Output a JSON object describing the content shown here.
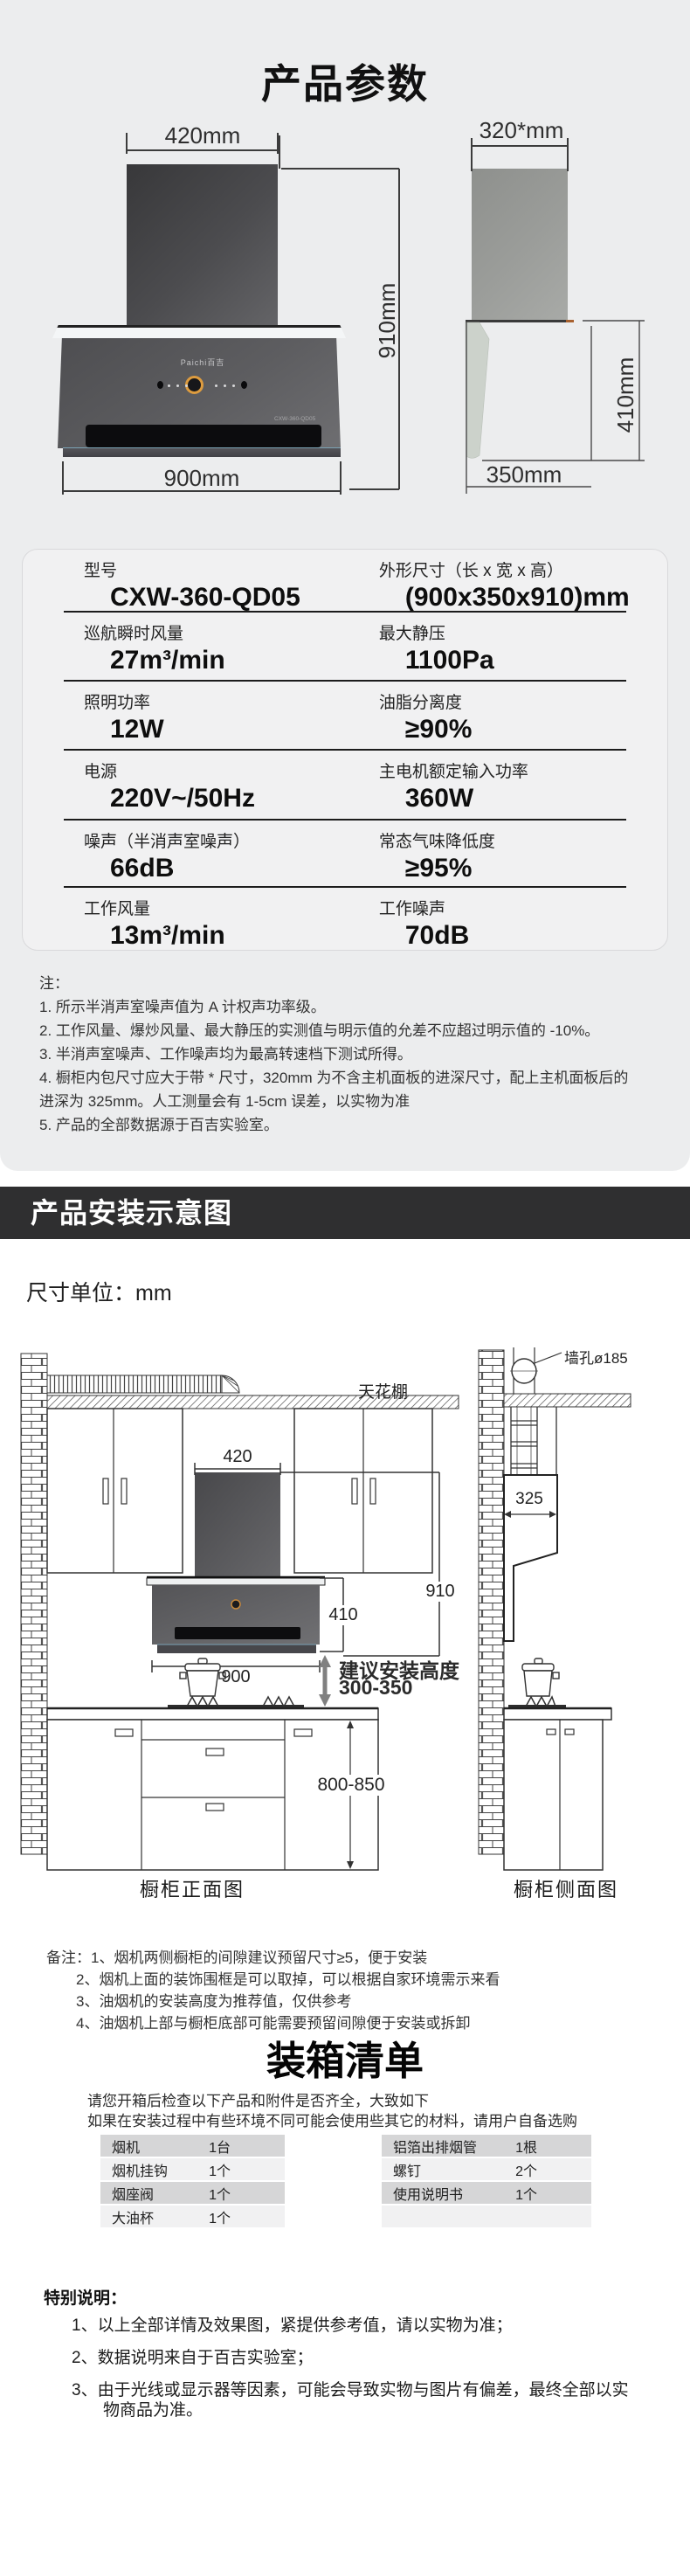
{
  "hero": {
    "title": "产品参数",
    "brand": "Paichi百吉",
    "badge": "CXW-360-QD05",
    "front": {
      "width_label": "420mm",
      "height_label": "910mm",
      "bottom_label": "900mm"
    },
    "side": {
      "top_label": "320*mm",
      "height_label": "410mm",
      "bottom_label": "350mm"
    }
  },
  "spec": {
    "rows": [
      {
        "left": {
          "label": "型号",
          "value": "CXW-360-QD05"
        },
        "right": {
          "label": "外形尺寸（长 x 宽 x 高）",
          "value": "(900x350x910)mm"
        }
      },
      {
        "left": {
          "label": "巡航瞬时风量",
          "value": "27m³/min"
        },
        "right": {
          "label": "最大静压",
          "value": "1100Pa"
        }
      },
      {
        "left": {
          "label": "照明功率",
          "value": "12W"
        },
        "right": {
          "label": "油脂分离度",
          "value": "≥90%"
        }
      },
      {
        "left": {
          "label": "电源",
          "value": "220V~/50Hz"
        },
        "right": {
          "label": "主电机额定输入功率",
          "value": "360W"
        }
      },
      {
        "left": {
          "label": "噪声（半消声室噪声）",
          "value": "66dB"
        },
        "right": {
          "label": "常态气味降低度",
          "value": "≥95%"
        }
      },
      {
        "left": {
          "label": "工作风量",
          "value": "13m³/min"
        },
        "right": {
          "label": "工作噪声",
          "value": "70dB"
        }
      }
    ]
  },
  "notes": {
    "heading": "注：",
    "items": [
      "1. 所示半消声室噪声值为 A 计权声功率级。",
      "2. 工作风量、爆炒风量、最大静压的实测值与明示值的允差不应超过明示值的 -10%。",
      "3. 半消声室噪声、工作噪声均为最高转速档下测试所得。",
      "4. 橱柜内包尺寸应大于带 * 尺寸，320mm 为不含主机面板的进深尺寸，配上主机面板后的进深为 325mm。人工测量会有 1-5cm 误差，以实物为准",
      "5. 产品的全部数据源于百吉实验室。"
    ]
  },
  "install": {
    "banner": "产品安装示意图",
    "unit": "尺寸单位：mm",
    "labels": {
      "ceiling": "天花棚",
      "wall_hole": "墙孔ø185",
      "dim_420": "420",
      "dim_910": "910",
      "dim_410": "410",
      "dim_900": "900",
      "dim_325": "325",
      "dim_800": "800-850",
      "height_line1": "建议安装高度",
      "height_line2": "300-350",
      "front_caption": "橱柜正面图",
      "side_caption": "橱柜侧面图"
    },
    "remarks": {
      "heading": "备注：",
      "items": [
        "1、烟机两侧橱柜的间隙建议预留尺寸≥5，便于安装",
        "2、烟机上面的装饰围框是可以取掉，可以根据自家环境需示来看",
        "3、油烟机的安装高度为推荐值，仅供参考",
        "4、油烟机上部与橱柜底部可能需要预留间隙便于安装或拆卸"
      ]
    }
  },
  "packing": {
    "title": "装箱清单",
    "intro": [
      "请您开箱后检查以下产品和附件是否齐全，大致如下",
      "如果在安装过程中有些环境不同可能会使用些其它的材料，请用户自备选购"
    ],
    "items_left": [
      {
        "name": "烟机",
        "qty": "1台"
      },
      {
        "name": "烟机挂钩",
        "qty": "1个"
      },
      {
        "name": "烟座阀",
        "qty": "1个"
      },
      {
        "name": "大油杯",
        "qty": "1个"
      }
    ],
    "items_right": [
      {
        "name": "铝箔出排烟管",
        "qty": "1根"
      },
      {
        "name": "螺钉",
        "qty": "2个"
      },
      {
        "name": "使用说明书",
        "qty": "1个"
      },
      {
        "name": "",
        "qty": ""
      }
    ]
  },
  "special": {
    "heading": "特别说明：",
    "items": [
      "1、以上全部详情及效果图，紧提供参考值，请以实物为准；",
      "2、数据说明来自于百吉实验室；",
      "3、由于光线或显示器等因素，可能会导致实物与图片有偏差，最终全部以实物商品为准。"
    ]
  }
}
